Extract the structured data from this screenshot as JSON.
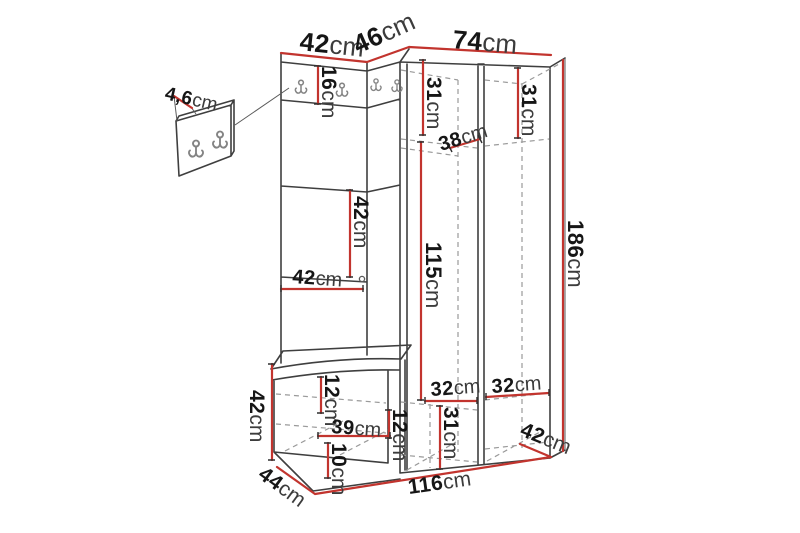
{
  "diagram": {
    "type": "furniture-dimension-diagram",
    "subject": "Hallway set: coat-hook panel with mirror, seat bench and corner wardrobe, shown with measurements",
    "unit": "cm",
    "colors": {
      "background": "#ffffff",
      "outline": "#3f3f3f",
      "hidden_line": "#9a9a9a",
      "dimension_line": "#c2342e",
      "label_number": "#161616",
      "label_unit": "#3c3c3c",
      "hook": "#848484"
    },
    "features": {
      "detail_panel_hooks": 2,
      "left_panel_hooks": 2,
      "corner_panel_hooks": 2,
      "mirror_knob": 1
    }
  },
  "dims": {
    "detail_panel_width": {
      "value": "4,6",
      "unit": "cm"
    },
    "left_section_width": {
      "value": "42",
      "unit": "cm"
    },
    "corner_section_width": {
      "value": "46",
      "unit": "cm"
    },
    "wardrobe_section_width": {
      "value": "74",
      "unit": "cm"
    },
    "hook_strip_height": {
      "value": "16",
      "unit": "cm"
    },
    "left_cubby_height": {
      "value": "31",
      "unit": "cm"
    },
    "right_cubby_height": {
      "value": "31",
      "unit": "cm"
    },
    "shelf_depth": {
      "value": "38",
      "unit": "cm"
    },
    "mirror_height": {
      "value": "42",
      "unit": "cm"
    },
    "left_panel_width": {
      "value": "42",
      "unit": "cm"
    },
    "hanging_space_height": {
      "value": "115",
      "unit": "cm"
    },
    "total_height": {
      "value": "186",
      "unit": "cm"
    },
    "bench_height": {
      "value": "42",
      "unit": "cm"
    },
    "seat_thickness": {
      "value": "12",
      "unit": "cm"
    },
    "bench_inner_width": {
      "value": "39",
      "unit": "cm"
    },
    "bench_inner_gap": {
      "value": "12",
      "unit": "cm"
    },
    "plinth_height": {
      "value": "10",
      "unit": "cm"
    },
    "bench_depth": {
      "value": "44",
      "unit": "cm"
    },
    "left_shelf_width": {
      "value": "32",
      "unit": "cm"
    },
    "right_shelf_width": {
      "value": "32",
      "unit": "cm"
    },
    "bottom_cubby_height": {
      "value": "31",
      "unit": "cm"
    },
    "wardrobe_depth": {
      "value": "42",
      "unit": "cm"
    },
    "total_width": {
      "value": "116",
      "unit": "cm"
    }
  }
}
